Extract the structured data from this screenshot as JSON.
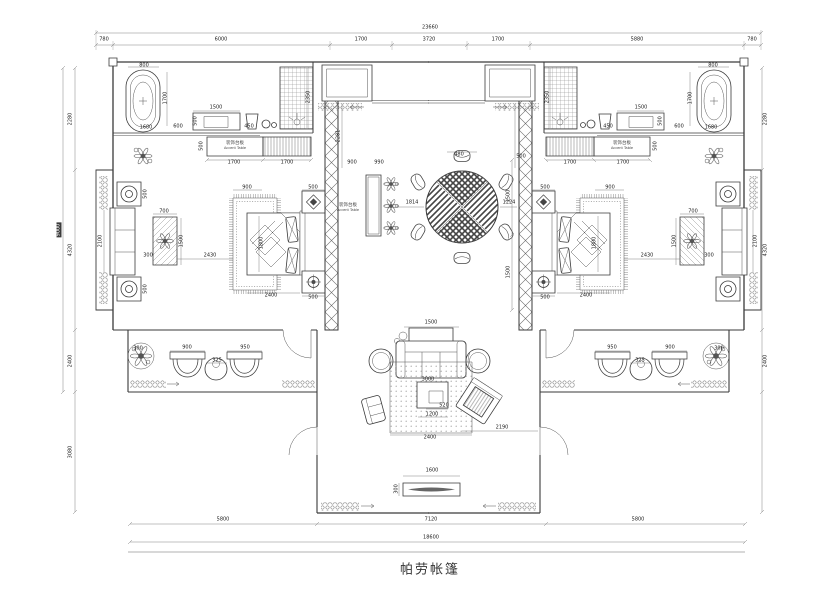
{
  "title": "帕劳帐篷",
  "colors": {
    "line": "#3a3a3a",
    "dim_text": "#222",
    "background": "#ffffff"
  },
  "room_labels": {
    "accent_table_left": {
      "zh": "装饰台板",
      "en": "Accent Table"
    },
    "accent_table_right": {
      "zh": "装饰台板",
      "en": "Accent Table"
    },
    "accent_console": {
      "zh": "装饰台板",
      "en": "Accent Table"
    }
  },
  "dimension_labels": [
    {
      "t": "23660",
      "x": 430,
      "y": 28
    },
    {
      "t": "780",
      "x": 104,
      "y": 40
    },
    {
      "t": "6000",
      "x": 221,
      "y": 40
    },
    {
      "t": "1700",
      "x": 361,
      "y": 40
    },
    {
      "t": "3720",
      "x": 429,
      "y": 40
    },
    {
      "t": "1700",
      "x": 498,
      "y": 40
    },
    {
      "t": "5880",
      "x": 637,
      "y": 40
    },
    {
      "t": "780",
      "x": 752,
      "y": 40
    },
    {
      "t": "5800",
      "x": 223,
      "y": 520
    },
    {
      "t": "7120",
      "x": 431,
      "y": 520
    },
    {
      "t": "5800",
      "x": 638,
      "y": 520
    },
    {
      "t": "18600",
      "x": 431,
      "y": 538
    },
    {
      "t": "2280",
      "x": 71,
      "y": 119,
      "r": -90
    },
    {
      "t": "4320",
      "x": 71,
      "y": 250,
      "r": -90
    },
    {
      "t": "2400",
      "x": 71,
      "y": 361,
      "r": -90
    },
    {
      "t": "3080",
      "x": 71,
      "y": 452,
      "r": -90
    },
    {
      "t": "9000",
      "x": 59,
      "y": 230,
      "r": -90,
      "dark": true
    },
    {
      "t": "2280",
      "x": 766,
      "y": 119,
      "r": -90
    },
    {
      "t": "4320",
      "x": 766,
      "y": 250,
      "r": -90
    },
    {
      "t": "2400",
      "x": 766,
      "y": 361,
      "r": -90
    },
    {
      "t": "800",
      "x": 144,
      "y": 66
    },
    {
      "t": "1700",
      "x": 166,
      "y": 98,
      "r": -90
    },
    {
      "t": "1680",
      "x": 146,
      "y": 128
    },
    {
      "t": "1500",
      "x": 216,
      "y": 108
    },
    {
      "t": "500",
      "x": 196,
      "y": 121,
      "r": -90
    },
    {
      "t": "600",
      "x": 178,
      "y": 127
    },
    {
      "t": "450",
      "x": 249,
      "y": 127
    },
    {
      "t": "2350",
      "x": 309,
      "y": 97,
      "r": -90
    },
    {
      "t": "1700",
      "x": 234,
      "y": 163
    },
    {
      "t": "1700",
      "x": 287,
      "y": 163
    },
    {
      "t": "500",
      "x": 202,
      "y": 146,
      "r": -90
    },
    {
      "t": "900",
      "x": 247,
      "y": 188
    },
    {
      "t": "1800",
      "x": 262,
      "y": 243,
      "r": -90
    },
    {
      "t": "2400",
      "x": 271,
      "y": 296
    },
    {
      "t": "500",
      "x": 313,
      "y": 188
    },
    {
      "t": "500",
      "x": 313,
      "y": 298
    },
    {
      "t": "700",
      "x": 164,
      "y": 212
    },
    {
      "t": "1500",
      "x": 182,
      "y": 241,
      "r": -90
    },
    {
      "t": "2430",
      "x": 210,
      "y": 256
    },
    {
      "t": "300",
      "x": 148,
      "y": 256
    },
    {
      "t": "2100",
      "x": 101,
      "y": 241,
      "r": -90
    },
    {
      "t": "500",
      "x": 146,
      "y": 194,
      "r": -90
    },
    {
      "t": "500",
      "x": 146,
      "y": 289,
      "r": -90
    },
    {
      "t": "300",
      "x": 138,
      "y": 349
    },
    {
      "t": "900",
      "x": 187,
      "y": 348
    },
    {
      "t": "950",
      "x": 245,
      "y": 348
    },
    {
      "t": "325",
      "x": 217,
      "y": 361
    },
    {
      "t": "480",
      "x": 459,
      "y": 155
    },
    {
      "t": "1814",
      "x": 412,
      "y": 203
    },
    {
      "t": "1224",
      "x": 509,
      "y": 203
    },
    {
      "t": "900",
      "x": 352,
      "y": 163
    },
    {
      "t": "990",
      "x": 379,
      "y": 163
    },
    {
      "t": "2281",
      "x": 339,
      "y": 136,
      "r": -90
    },
    {
      "t": "1500",
      "x": 509,
      "y": 196,
      "r": -90
    },
    {
      "t": "1500",
      "x": 509,
      "y": 272,
      "r": -90
    },
    {
      "t": "500",
      "x": 521,
      "y": 157
    },
    {
      "t": "500",
      "x": 545,
      "y": 188
    },
    {
      "t": "500",
      "x": 545,
      "y": 298
    },
    {
      "t": "1800",
      "x": 595,
      "y": 243,
      "r": -90
    },
    {
      "t": "2400",
      "x": 586,
      "y": 296
    },
    {
      "t": "900",
      "x": 610,
      "y": 188
    },
    {
      "t": "1700",
      "x": 570,
      "y": 163
    },
    {
      "t": "1700",
      "x": 623,
      "y": 163
    },
    {
      "t": "500",
      "x": 656,
      "y": 146,
      "r": -90
    },
    {
      "t": "800",
      "x": 713,
      "y": 66
    },
    {
      "t": "1700",
      "x": 691,
      "y": 98,
      "r": -90
    },
    {
      "t": "1680",
      "x": 711,
      "y": 128
    },
    {
      "t": "1500",
      "x": 641,
      "y": 108
    },
    {
      "t": "500",
      "x": 661,
      "y": 121,
      "r": -90
    },
    {
      "t": "600",
      "x": 679,
      "y": 127
    },
    {
      "t": "450",
      "x": 608,
      "y": 127
    },
    {
      "t": "2350",
      "x": 548,
      "y": 97,
      "r": -90
    },
    {
      "t": "700",
      "x": 693,
      "y": 212
    },
    {
      "t": "1500",
      "x": 675,
      "y": 241,
      "r": -90
    },
    {
      "t": "2430",
      "x": 647,
      "y": 256
    },
    {
      "t": "300",
      "x": 709,
      "y": 256
    },
    {
      "t": "2100",
      "x": 756,
      "y": 241,
      "r": -90
    },
    {
      "t": "300",
      "x": 719,
      "y": 349
    },
    {
      "t": "900",
      "x": 670,
      "y": 348
    },
    {
      "t": "950",
      "x": 612,
      "y": 348
    },
    {
      "t": "325",
      "x": 640,
      "y": 361
    },
    {
      "t": "1500",
      "x": 431,
      "y": 323
    },
    {
      "t": "3000",
      "x": 428,
      "y": 380
    },
    {
      "t": "520",
      "x": 444,
      "y": 406
    },
    {
      "t": "1200",
      "x": 432,
      "y": 415
    },
    {
      "t": "2400",
      "x": 430,
      "y": 438
    },
    {
      "t": "2190",
      "x": 502,
      "y": 428
    },
    {
      "t": "1600",
      "x": 432,
      "y": 471
    },
    {
      "t": "300",
      "x": 397,
      "y": 489,
      "r": -90
    }
  ]
}
